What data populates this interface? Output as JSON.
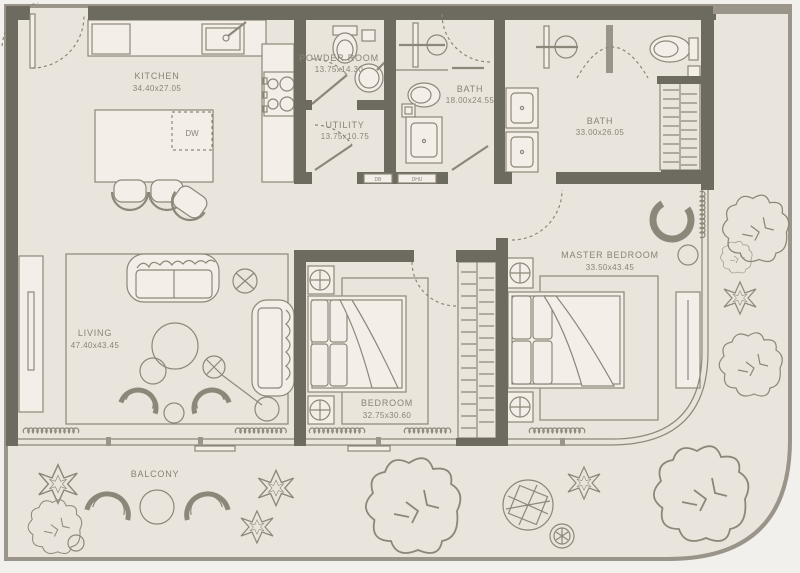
{
  "colors": {
    "wall": "#6d6a60",
    "floor": "#e9e4dc",
    "outside": "#f2f0ed",
    "line": "#8d8779",
    "fixture": "#f3efe8",
    "label_text": "#8a8477"
  },
  "rooms": {
    "kitchen": {
      "label": "KITCHEN",
      "dims": "34.40x27.05"
    },
    "powder_room": {
      "label": "POWDER ROOM",
      "dims": "13.75x14.30"
    },
    "utility": {
      "label": "UTILITY",
      "dims": "13.75x10.75"
    },
    "bath": {
      "label": "BATH",
      "dims": "18.00x24.55"
    },
    "master_bath": {
      "label": "BATH",
      "dims": "33.00x26.05"
    },
    "master_bedroom": {
      "label": "MASTER BEDROOM",
      "dims": "33.50x43.45"
    },
    "bedroom": {
      "label": "BEDROOM",
      "dims": "32.75x30.60"
    },
    "living": {
      "label": "LIVING",
      "dims": "47.40x43.45"
    },
    "balcony": {
      "label": "BALCONY"
    }
  },
  "tags": {
    "dishwasher": "DW",
    "db": "DB",
    "dhu": "DHU"
  }
}
